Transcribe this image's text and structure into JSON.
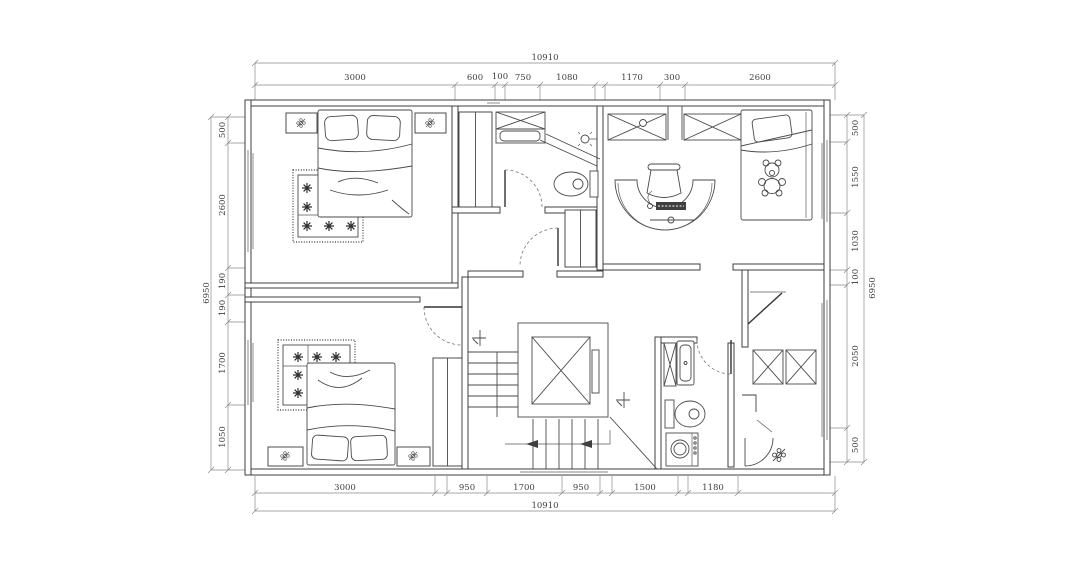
{
  "drawing": {
    "type": "architectural-floor-plan",
    "background_color": "#ffffff",
    "line_color": "#3f3f3f",
    "dimension_text_color": "#3f3f3f"
  },
  "dimensions": {
    "top": {
      "total": "10910",
      "segments": [
        "3000",
        "600",
        "100",
        "750",
        "1080",
        "1170",
        "300",
        "2600"
      ]
    },
    "bottom": {
      "total": "10910",
      "segments": [
        "3000",
        "950",
        "1700",
        "950",
        "1500",
        "1180"
      ]
    },
    "left": {
      "total": "6950",
      "segments": [
        "500",
        "2600",
        "190",
        "190",
        "1700",
        "1050"
      ]
    },
    "right": {
      "total": "6950",
      "segments": [
        "500",
        "1550",
        "1030",
        "100",
        "2050",
        "500"
      ]
    }
  }
}
